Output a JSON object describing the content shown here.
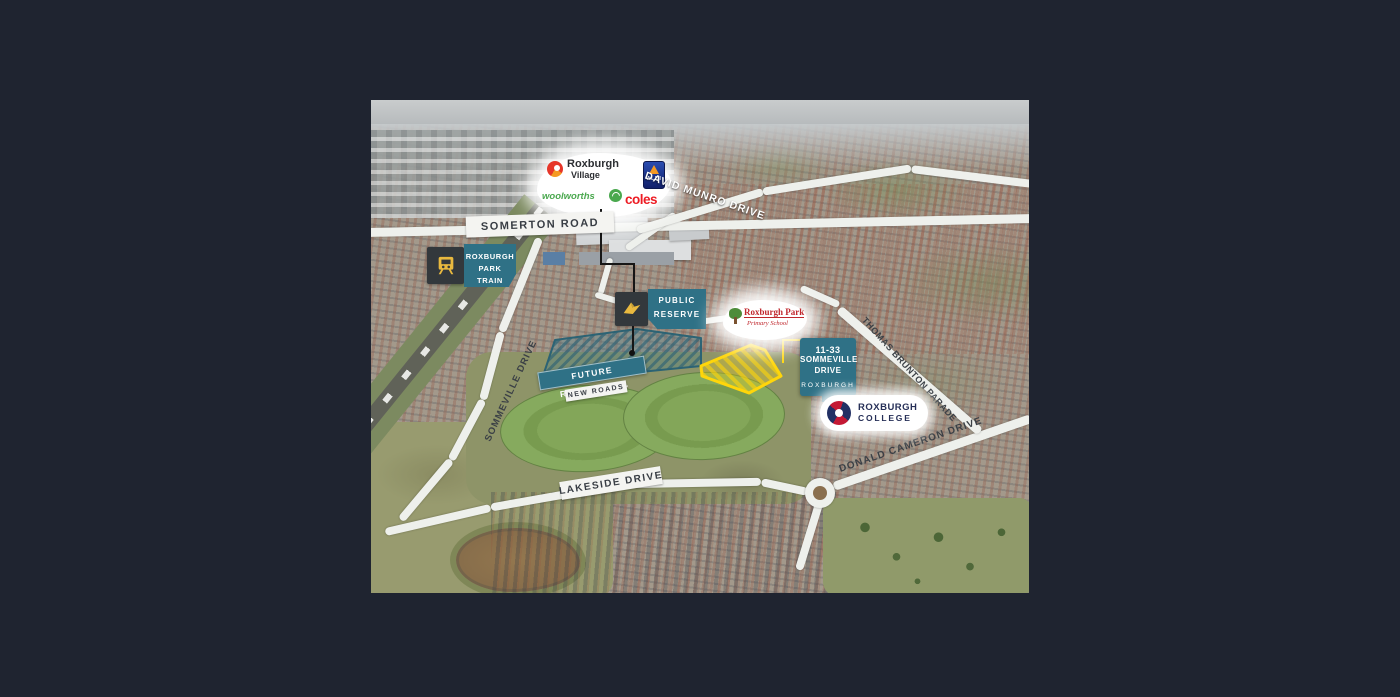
{
  "page": {
    "background_color": "#1f2430"
  },
  "logos": {
    "roxburgh_village": {
      "line1": "Roxburgh",
      "line2": "Village"
    },
    "aldi": "ALDI",
    "woolworths": "woolworths",
    "coles": "coles"
  },
  "roads": {
    "somerton": "SOMERTON ROAD",
    "david_munro": "DAVID MUNRO DRIVE",
    "sommeville": "SOMMEVILLE DRIVE",
    "lakeside": "LAKESIDE DRIVE",
    "donald_cameron": "DONALD CAMERON DRIVE",
    "thomas_brunton": "THOMAS BRUNTON PARADE"
  },
  "badges": {
    "train_station": {
      "line1": "ROXBURGH PARK",
      "line2": "TRAIN STATION",
      "icon": "train-icon"
    },
    "public_reserve": {
      "line1": "PUBLIC",
      "line2": "RESERVE",
      "icon": "bird-icon"
    },
    "site": {
      "line1": "11-33",
      "line2": "SOMMEVILLE",
      "line3": "DRIVE",
      "line4": "ROXBURGH"
    },
    "college": {
      "line1": "ROXBURGH",
      "line2": "COLLEGE"
    },
    "primary_school": {
      "line1": "Roxburgh Park",
      "line2": "Primary School"
    }
  },
  "zones": {
    "future_residential": "FUTURE RESIDENTIAL",
    "new_roads": "NEW ROADS"
  },
  "colors": {
    "teal_badge": "#2f7186",
    "badge_dark": "#33383c",
    "icon_yellow": "#e9b93f",
    "site_yellow": "#ffd60a",
    "coles_red": "#ed1c24",
    "woolworths_green": "#4aa84e",
    "aldi_blue": "#1b2f7e",
    "school_red": "#c0272d",
    "college_navy": "#262f57"
  }
}
